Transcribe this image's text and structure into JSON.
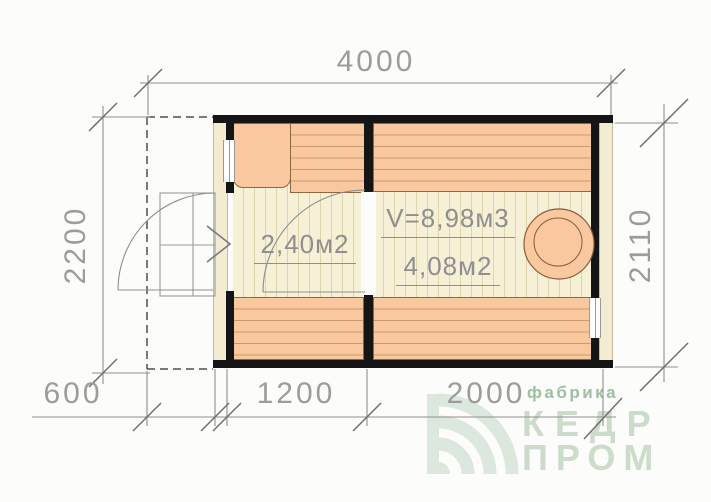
{
  "dimensions": {
    "total_width": "4000",
    "left_height": "2200",
    "right_height": "2110",
    "porch_width": "600",
    "vestibule_width": "1200",
    "main_room_width": "2000"
  },
  "room_labels": {
    "vestibule_area": "2,40м2",
    "steam_room_volume": "V=8,98м3",
    "steam_room_area": "4,08м2"
  },
  "logo": {
    "tagline": "фабрика",
    "name_line1": "КЕДР",
    "name_line2": "ПРОМ"
  },
  "colors": {
    "bench_fill": "#f9c89e",
    "bench_plank_line": "#cd9a6d",
    "floor_fill": "#f6f0d6",
    "floor_plank_line": "#ded5ad",
    "wall_black": "#151515",
    "wall_timber_fill": "#f3ecd2",
    "drawing_line_gray": "#8f8f8f",
    "dimension_text_gray": "#9c9c9c",
    "logo_green": "#9cc0a2",
    "logo_light_green": "#ccdccb"
  }
}
